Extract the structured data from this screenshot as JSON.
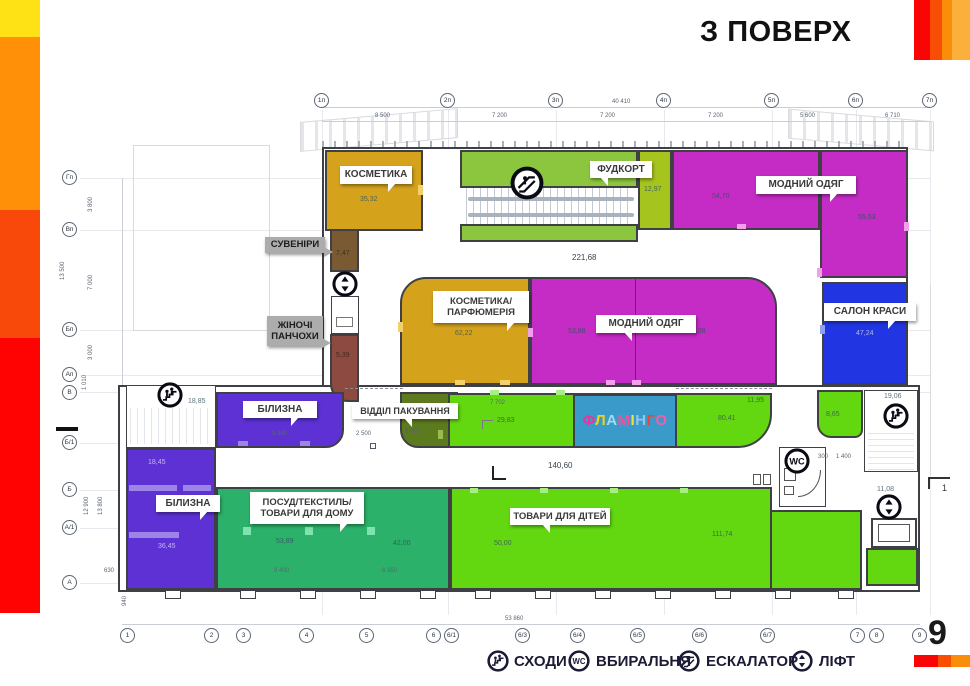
{
  "title": "З ПОВЕРХ",
  "page_number": "9",
  "legend": {
    "stairs": "СХОДИ",
    "wc": "ВБИРАЛЬНЯ",
    "escalator": "ЕСКАЛАТОР",
    "lift": "ЛІФТ"
  },
  "zones": {
    "cosmetics": "КОСМЕТИКА",
    "foodcourt": "ФУДКОРТ",
    "fashion_top": "МОДНИЙ ОДЯГ",
    "souvenirs": "СУВЕНІРИ",
    "stockings_l1": "ЖІНОЧІ",
    "stockings_l2": "ПАНЧОХИ",
    "perfume_l1": "КОСМЕТИКА/",
    "perfume_l2": "ПАРФЮМЕРІЯ",
    "fashion_center": "МОДНИЙ ОДЯГ",
    "beauty": "САЛОН КРАСИ",
    "linen_top": "БІЛИЗНА",
    "packaging": "ВІДДІЛ ПАКУВАННЯ",
    "linen_bottom": "БІЛИЗНА",
    "housewares_l1": "ПОСУД/ТЕКСТИЛЬ/",
    "housewares_l2": "ТОВАРИ ДЛЯ ДОМУ",
    "kids": "ТОВАРИ ДЛЯ ДІТЕЙ"
  },
  "flamingo": {
    "letters": [
      "Ф",
      "Л",
      "А",
      "М",
      "І",
      "Н",
      "Г",
      "О"
    ],
    "colors": [
      "#E8359C",
      "#F5D211",
      "#9FDDF2",
      "#F0509E",
      "#F2E23A",
      "#8CC8EE",
      "#F04438",
      "#F060A8"
    ],
    "background": "#3A9AC9"
  },
  "colors": {
    "ochre": "#D5A21C",
    "brown": "#7A5A33",
    "maroon": "#8C4A40",
    "magenta": "#C52BC5",
    "blue": "#2136E2",
    "yellow_green": "#8CC63E",
    "olive_strip": "#A6C41E",
    "bright_green": "#63D70F",
    "sea_green": "#2BB169",
    "dark_olive": "#5C7A1E",
    "purple": "#5D31D4"
  },
  "areas": {
    "cosmetics": "35,32",
    "souvenirs": "7,47",
    "stockings": "5,39",
    "foodcourt_strip": "12,97",
    "fashion_a": "54,70",
    "fashion_b": "55,53",
    "perfume": "62,22",
    "fashion_c1": "53,88",
    "fashion_c2": "68,38",
    "beauty": "47,24",
    "hall_top": "221,68",
    "hall_mid": "140,60",
    "stairs_left": "18,85",
    "strip_a": "29,83",
    "strip_b": "80,41",
    "strip_c": "11,95",
    "strip_d": "8,65",
    "stairs_right": "19,06",
    "lift_right": "11,08",
    "linen_b1": "18,45",
    "linen_b2": "36,45",
    "housewares_a": "53,89",
    "housewares_b": "42,00",
    "kids_a": "50,00",
    "kids_b": "111,74"
  },
  "dims": {
    "top_total": "40 410",
    "top": [
      "8 500",
      "7 200",
      "7 200",
      "7 200",
      "5 600",
      "6 710"
    ],
    "left_total": "13 500",
    "left": [
      "3 800",
      "7 000",
      "3 000",
      "1 010"
    ],
    "left_lower": [
      "12 900",
      "13 800"
    ],
    "bottom_total": "53 860",
    "inner": {
      "linen_top": "9 340",
      "pack_w": "2 500",
      "pack_h": "3 002",
      "strip": "7 702",
      "wc_a": "300",
      "wc_b": "1 400",
      "house_a": "8 400",
      "house_b": "6 350",
      "linen_w": "630",
      "base": "940"
    }
  },
  "axes": {
    "top": [
      "1п",
      "2п",
      "3п",
      "4п",
      "5п",
      "6п",
      "7п"
    ],
    "left": [
      "Гп",
      "Вп",
      "Бп",
      "Ап",
      "В"
    ],
    "left_lower": [
      "Б/1",
      "Б",
      "А/1",
      "А"
    ],
    "bottom": [
      "1",
      "2",
      "3",
      "4",
      "5",
      "6",
      "6/1",
      "6/3",
      "6/4",
      "6/5",
      "6/6",
      "6/7",
      "7",
      "8",
      "9"
    ],
    "section_right": "1"
  }
}
